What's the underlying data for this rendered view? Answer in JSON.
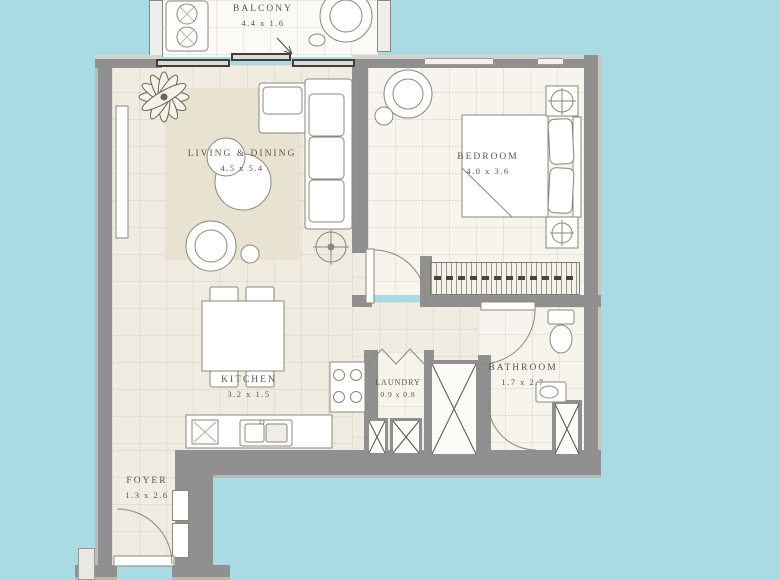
{
  "plan": {
    "type": "apartment-floor-plan",
    "background_color": "#a8dbe3",
    "wall_color": "#909090",
    "floor_color": "#f1ece1",
    "rug_color": "#e8e3d1",
    "label_color": "#57544b",
    "rooms": [
      {
        "id": "balcony",
        "name": "BALCONY",
        "dimensions": "4.4 x 1.6"
      },
      {
        "id": "living-dining",
        "name": "LIVING & DINING",
        "dimensions": "4.5 x 5.4"
      },
      {
        "id": "bedroom",
        "name": "BEDROOM",
        "dimensions": "4.0 x 3.6"
      },
      {
        "id": "kitchen",
        "name": "KITCHEN",
        "dimensions": "3.2 x 1.5"
      },
      {
        "id": "laundry",
        "name": "LAUNDRY",
        "dimensions": "0.9 x 0.8"
      },
      {
        "id": "bathroom",
        "name": "BATHROOM",
        "dimensions": "1.7 x 2.7"
      },
      {
        "id": "foyer",
        "name": "FOYER",
        "dimensions": "1.3 x 2.6"
      }
    ]
  }
}
